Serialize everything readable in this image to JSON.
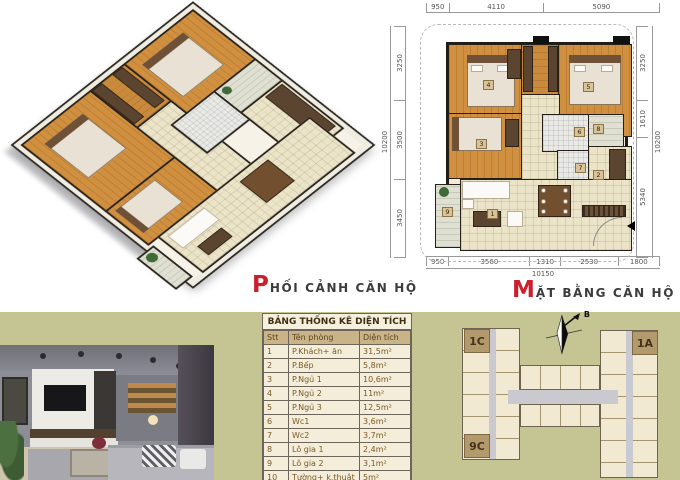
{
  "captions": {
    "perspective": {
      "initial": "P",
      "rest": "HỐI CẢNH CĂN HỘ"
    },
    "floorplan": {
      "initial": "M",
      "rest": "ẶT BẰNG CĂN HỘ"
    }
  },
  "floor_plan": {
    "dims": {
      "top": [
        "950",
        "4110",
        "5090"
      ],
      "bottom": [
        "950",
        "3560",
        "1310",
        "2530",
        "1800"
      ],
      "bottom_total": "10150",
      "left": [
        "3250",
        "3500",
        "3450"
      ],
      "left_total": "10200",
      "right": [
        "3250",
        "1610",
        "5340"
      ],
      "right_total": "10200"
    },
    "room_badges": [
      "1",
      "2",
      "3",
      "4",
      "5",
      "6",
      "7",
      "8",
      "9"
    ]
  },
  "area_table": {
    "title": "BẢNG THỐNG KÊ DIỆN TÍCH",
    "headers": [
      "Stt",
      "Tên phòng",
      "Diện tích"
    ],
    "rows": [
      [
        "1",
        "P.Khách+ ăn",
        "31,5m²"
      ],
      [
        "2",
        "P.Bếp",
        "5,8m²"
      ],
      [
        "3",
        "P.Ngủ 1",
        "10,6m²"
      ],
      [
        "4",
        "P.Ngủ 2",
        "11m²"
      ],
      [
        "5",
        "P.Ngủ 3",
        "12,5m²"
      ],
      [
        "6",
        "Wc1",
        "3,6m²"
      ],
      [
        "7",
        "Wc2",
        "3,7m²"
      ],
      [
        "8",
        "Lô gia 1",
        "2,4m²"
      ],
      [
        "9",
        "Lô gia 2",
        "3,1m²"
      ],
      [
        "10",
        "Tường+ k.thuật",
        "5m²"
      ]
    ]
  },
  "site_plan": {
    "unit_top_left": "1C",
    "unit_top_right": "1A",
    "unit_bottom_left": "9C",
    "compass_label": "B"
  },
  "colors": {
    "accent_red": "#cc1f2d",
    "olive_background": "#c4c592",
    "wood_floor": "#d0903f",
    "tile_floor": "#ebe4c8",
    "unit_fill": "#f1e9d1",
    "unit_tag": "#b29a6d",
    "table_header": "#c9b488"
  }
}
